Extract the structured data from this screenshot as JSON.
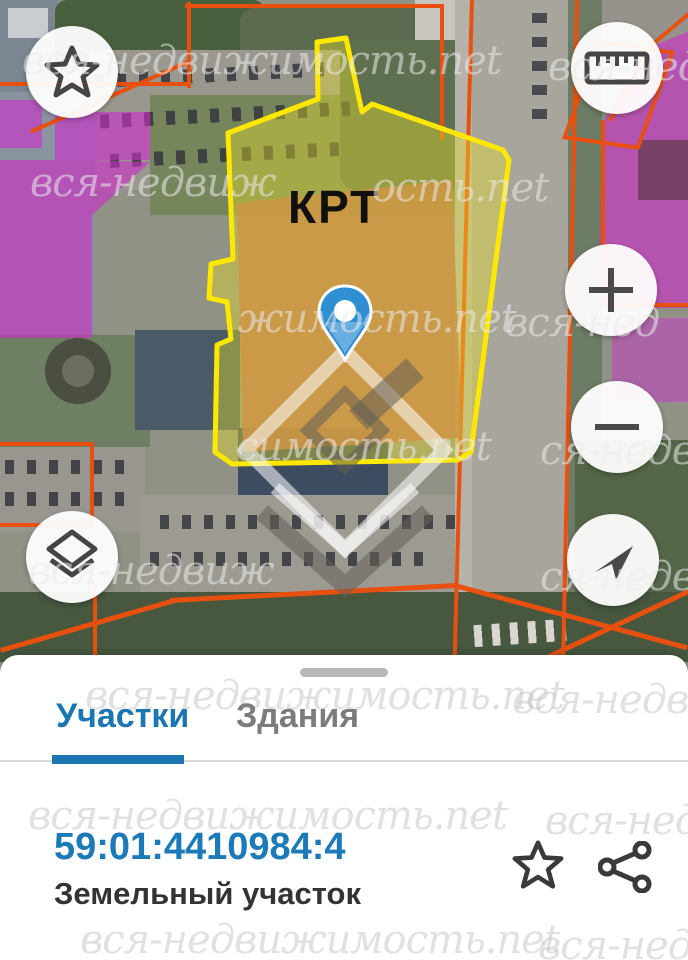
{
  "map": {
    "parcel_label": "КРТ",
    "marker": "location-pin",
    "controls": {
      "favorite_icon": "star-icon",
      "measure_icon": "ruler-icon",
      "zoom_in_icon": "plus-icon",
      "zoom_out_icon": "minus-icon",
      "layers_icon": "layers-icon",
      "locate_icon": "navigation-arrow-icon"
    }
  },
  "watermarks": [
    {
      "text": "вся-недвижимость.net"
    },
    {
      "text": "вся-недв"
    },
    {
      "text": "вся-недвиж"
    },
    {
      "text": "ость.net"
    },
    {
      "text": "жимость.net"
    },
    {
      "text": "вся-нед"
    },
    {
      "text": "симость.net"
    },
    {
      "text": "ся-недв"
    },
    {
      "text": "вся-недвиж"
    },
    {
      "text": "ся-недв"
    },
    {
      "text": "вся-недвижимость.net"
    },
    {
      "text": "вся-недви"
    },
    {
      "text": "вся-недвижимость.net"
    },
    {
      "text": "вся-недв"
    },
    {
      "text": "вся-недвижимость.net"
    },
    {
      "text": "вся-недв"
    }
  ],
  "panel": {
    "tabs": [
      {
        "label": "Участки",
        "active": true
      },
      {
        "label": "Здания",
        "active": false
      }
    ],
    "object": {
      "cadastral_number": "59:01:4410984:4",
      "type": "Земельный участок"
    },
    "actions": {
      "favorite_icon": "star-icon",
      "share_icon": "share-icon"
    }
  },
  "colors": {
    "accent_blue": "#1b76b2",
    "parcel_outline_yellow": "#ffe800",
    "zone_magenta": "#ce2ccc",
    "boundary_orange": "#e8500f",
    "building_tan": "#cf9644"
  }
}
